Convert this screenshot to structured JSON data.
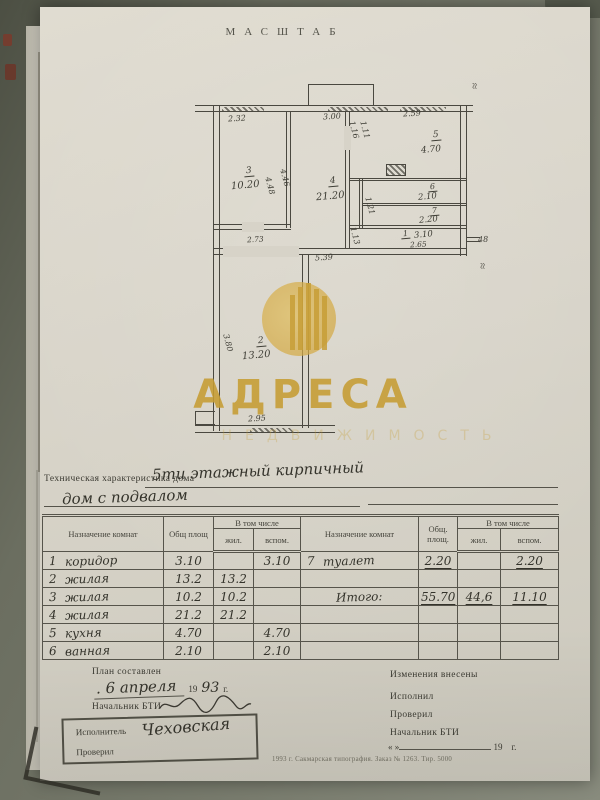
{
  "title": {
    "scale": "МАСШТАБ"
  },
  "plan": {
    "dims": {
      "top1": "2.32",
      "top2": "3.00",
      "top3": "2.59",
      "r3n": "3",
      "r3a": "10.20",
      "r3v1": "4.48",
      "r3v2": "4.46",
      "r4n": "4",
      "r4a": "21.20",
      "r5n": "5",
      "r5a": "4.70",
      "r6n": "6",
      "r6a": "2.10",
      "r7n": "7",
      "r7a": "2.20",
      "r1n": "1",
      "r1a": "3.10",
      "r1w": "2.65",
      "r2n": "2",
      "r2a": "13.20",
      "r2v": "3.80",
      "r2w": "2.95",
      "hall": "5.39",
      "d273": "2.73",
      "wall48": "48",
      "s1": "1.16",
      "s2": "1.11",
      "s3": "1.21",
      "s4": "1.13",
      "break": "≈"
    }
  },
  "watermark": {
    "brand": "АДРЕСА",
    "tagline": "НЕДВИЖИМОСТЬ",
    "gold": "#c69d33"
  },
  "tech": {
    "label": "Техническая характеристика дома",
    "hand1": "5ти этажный кирпичный",
    "hand2": "дом с подвалом"
  },
  "table": {
    "header": {
      "name": "Назначение комнат",
      "total": "Общ площ",
      "incl": "В том числе",
      "living": "жил.",
      "aux": "вспом.",
      "name2": "Назначение комнат",
      "total2": "Общ. площ.",
      "incl2": "В том числе",
      "living2": "жил.",
      "aux2": "вспом."
    },
    "rows": [
      {
        "ln": "1",
        "lname": "коридор",
        "lt": "3.10",
        "lj": "",
        "lv": "3.10",
        "rn": "7",
        "rname": "туалет",
        "rt": "2.20",
        "rj": "",
        "rv": "2.20"
      },
      {
        "ln": "2",
        "lname": "жилая",
        "lt": "13.2",
        "lj": "13.2",
        "lv": "",
        "rn": "",
        "rname": "",
        "rt": "",
        "rj": "",
        "rv": ""
      },
      {
        "ln": "3",
        "lname": "жилая",
        "lt": "10.2",
        "lj": "10.2",
        "lv": "",
        "rn": "",
        "rname": "Итого:",
        "rt": "55.70",
        "rj": "44,6",
        "rv": "11.10"
      },
      {
        "ln": "4",
        "lname": "жилая",
        "lt": "21.2",
        "lj": "21.2",
        "lv": "",
        "rn": "",
        "rname": "",
        "rt": "",
        "rj": "",
        "rv": ""
      },
      {
        "ln": "5",
        "lname": "кухня",
        "lt": "4.70",
        "lj": "",
        "lv": "4.70",
        "rn": "",
        "rname": "",
        "rt": "",
        "rj": "",
        "rv": ""
      },
      {
        "ln": "6",
        "lname": "ванная",
        "lt": "2.10",
        "lj": "",
        "lv": "2.10",
        "rn": "",
        "rname": "",
        "rt": "",
        "rj": "",
        "rv": ""
      }
    ]
  },
  "footer": {
    "left": {
      "plan_made": "План составлен",
      "date_hand": ". 6 апреля",
      "year_print": "19",
      "year_hand": "93",
      "year_g": "г.",
      "chief_label": "Начальник БТИ",
      "executor_label": "Исполнитель",
      "executor_name": "Чеховская",
      "checked_label": "Проверил"
    },
    "right": {
      "changes": "Изменения внесены",
      "performed": "Исполнил",
      "checked": "Проверил",
      "chief": "Начальник БТИ",
      "quote": "«        »",
      "year": "19",
      "year_g": "г."
    },
    "printline": "1993 г. Сакмарская типография. Заказ № 1263. Тир. 5000"
  }
}
